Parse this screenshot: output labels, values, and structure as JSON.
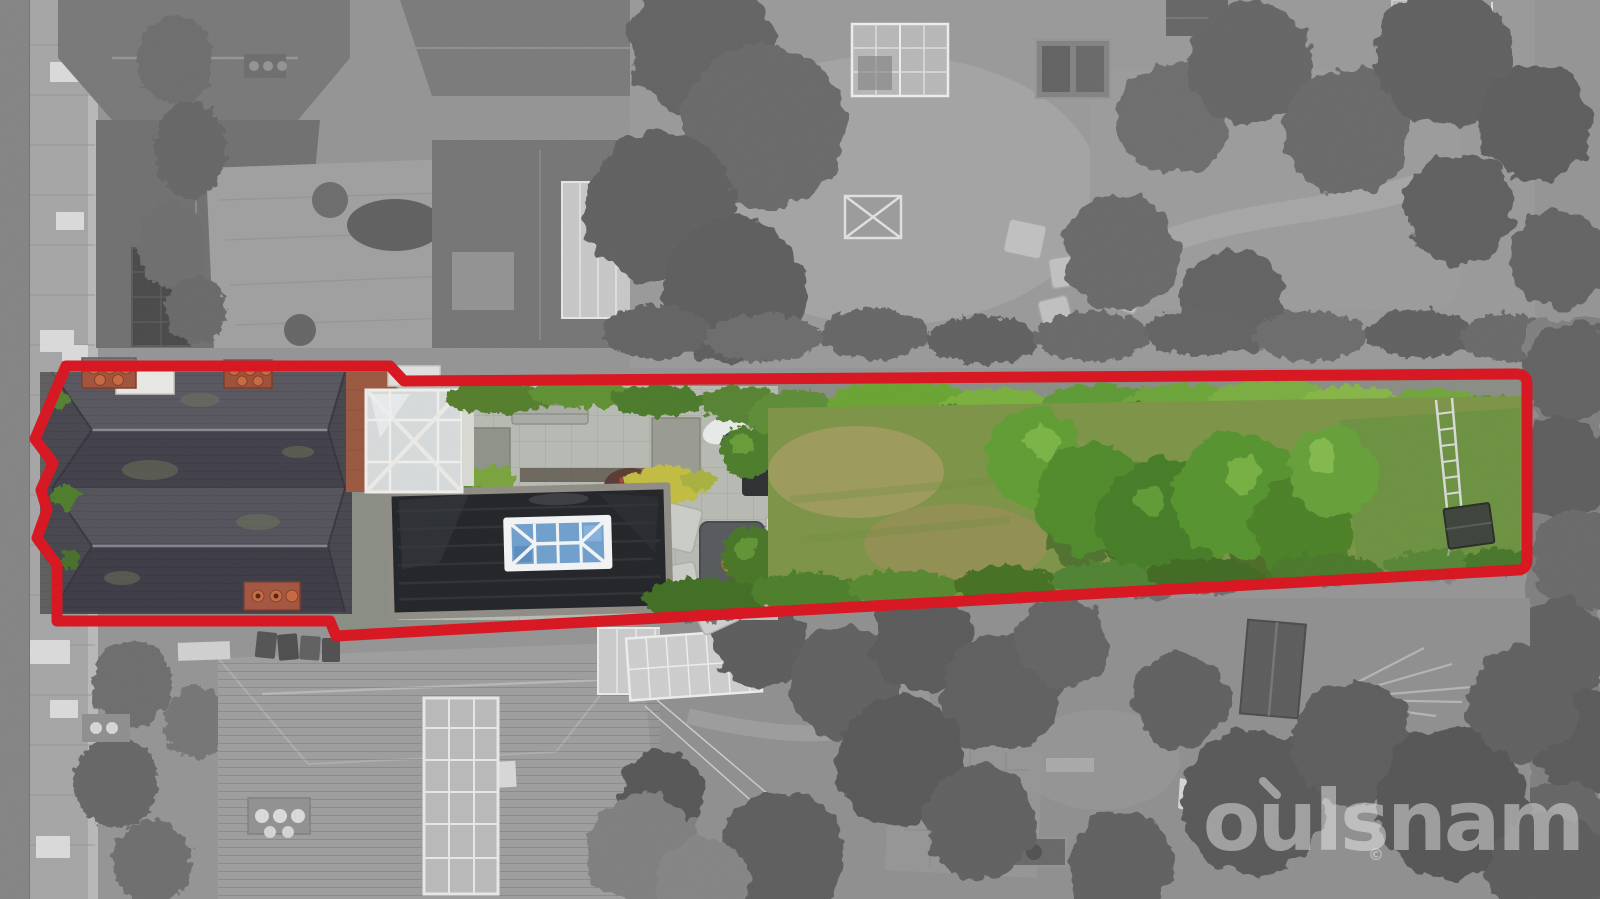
{
  "image": {
    "kind": "Estate-agent aerial drone photograph",
    "description": "Bird's-eye view of a long residential plot outlined in red; inside the outline the photograph is in full colour (house, black flat roof with glazed lantern, patio, long lawn and mature trees) while the surrounding neighbourhood is desaturated to greyscale.",
    "width_px": 1600,
    "height_px": 899
  },
  "boundary": {
    "color": "#d8141f",
    "stroke_width": 11,
    "style": "solid",
    "shape": "elongated plot outline with zig-zag left edge following the house frontage"
  },
  "watermark": {
    "text": "oulsnam",
    "accent": "diagonal tick above the letter o",
    "copyright_symbol": "©",
    "color": "#ffffff",
    "opacity": 0.42
  },
  "scene": {
    "inside_boundary": [
      "victorian house with grey slate roofs",
      "brick chimney stacks with terracotta pots",
      "white glazed conservatory roof",
      "black flat garage roof with blue glazed roof lantern",
      "paved patio with bench, planters and dining set",
      "long rear lawn with dry patches",
      "bright green hedges and mature trees",
      "ladder and small dark shed at the far end of the garden"
    ],
    "outside_boundary": [
      "street and pavement on the left (greyscale)",
      "neighbouring houses, roofs and a solar panel",
      "block-paved driveway",
      "neighbouring gardens with greenhouse, trampoline and garden furniture",
      "dense grey tree canopies",
      "conservatory, sheds, cold frames and a stone path in the lower gardens"
    ]
  }
}
